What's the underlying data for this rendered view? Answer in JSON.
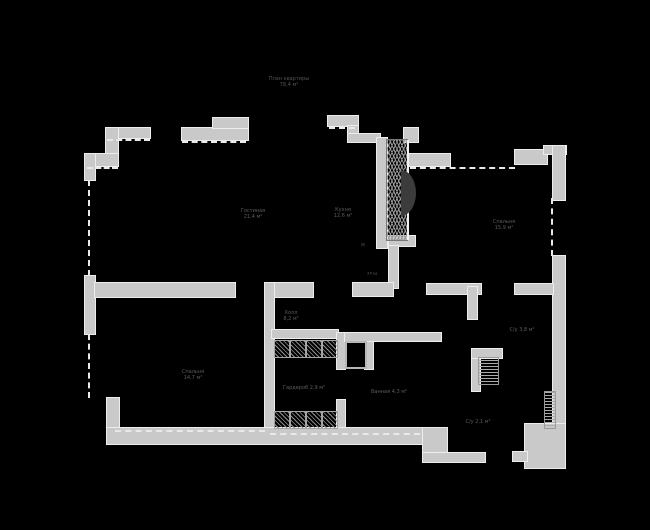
{
  "plan": {
    "title": {
      "line1": "План квартиры",
      "line2": "78,4 м²"
    },
    "rooms": {
      "living": {
        "name": "Гостиная",
        "area": "21,4 м²"
      },
      "kitchen": {
        "name": "Кухня",
        "area": "12,6 м²"
      },
      "bedroom_top": {
        "name": "Спальня",
        "area": "15,9 м²"
      },
      "bedroom_bottom": {
        "name": "Спальня",
        "area": "14,7 м²"
      },
      "hall": {
        "name": "Холл",
        "area": "8,2 м²"
      },
      "wardrobe": {
        "name": "Гардероб",
        "area": "2,9 м²"
      },
      "bathroom": {
        "name": "Ванная",
        "area": "4,3 м²"
      },
      "wc": {
        "name": "С/у",
        "area": "3,8 м²"
      },
      "storage": {
        "name": "С/у",
        "area": "2,1 м²"
      }
    },
    "annotations": {
      "shaft": "М",
      "panel": "эл.щ"
    },
    "colors": {
      "background": "#000000",
      "wall": "#c9c9c9",
      "wall_edge": "#ededed",
      "window_dash": "#e9e9e9",
      "hatch": "#9c9c9c",
      "label_text": "#5d5d5d"
    }
  }
}
